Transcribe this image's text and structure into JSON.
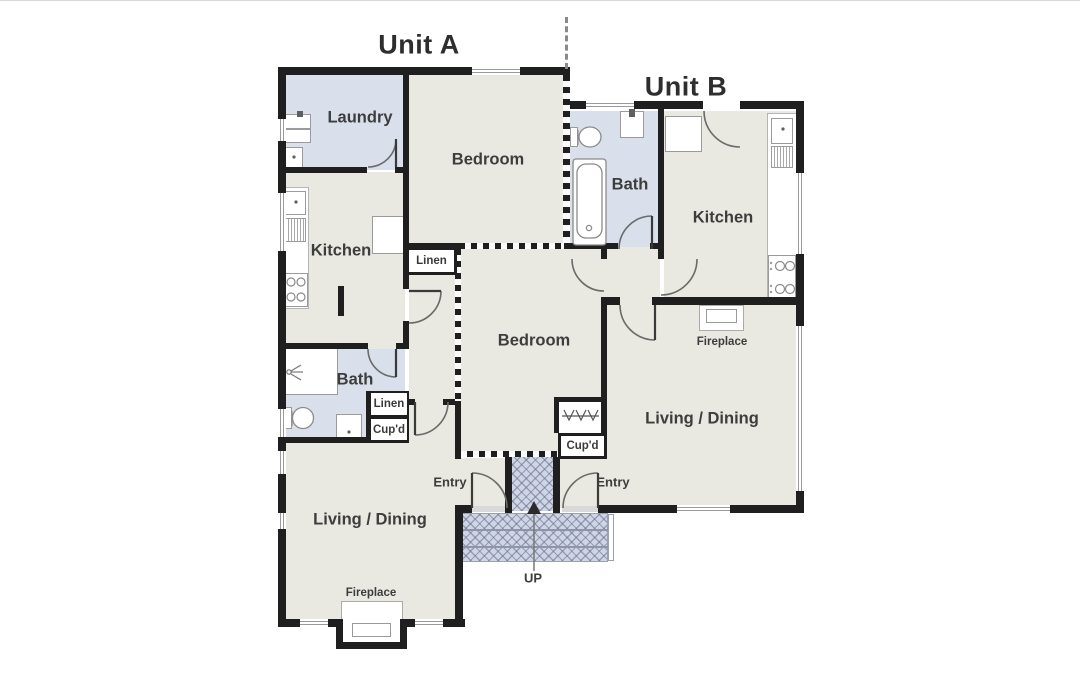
{
  "titles": {
    "unit_a": "Unit A",
    "unit_b": "Unit B"
  },
  "rooms": {
    "laundry": "Laundry",
    "bedroom_a": "Bedroom",
    "bath_b": "Bath",
    "kitchen_b": "Kitchen",
    "kitchen_a": "Kitchen",
    "bedroom_b": "Bedroom",
    "bath_a": "Bath",
    "living_b": "Living / Dining",
    "living_a": "Living / Dining"
  },
  "closets": {
    "linen_hall": "Linen",
    "linen_bath": "Linen",
    "cupd_bath": "Cup'd",
    "cupd_b": "Cup'd"
  },
  "features": {
    "fireplace_a": "Fireplace",
    "fireplace_b": "Fireplace",
    "entry_a": "Entry",
    "entry_b": "Entry",
    "up": "UP"
  },
  "colors": {
    "floor": "#e9e9e2",
    "wet_room": "#d9e0eb",
    "wall": "#1f1f1f",
    "porch_hatch": "#cfd5e3"
  }
}
